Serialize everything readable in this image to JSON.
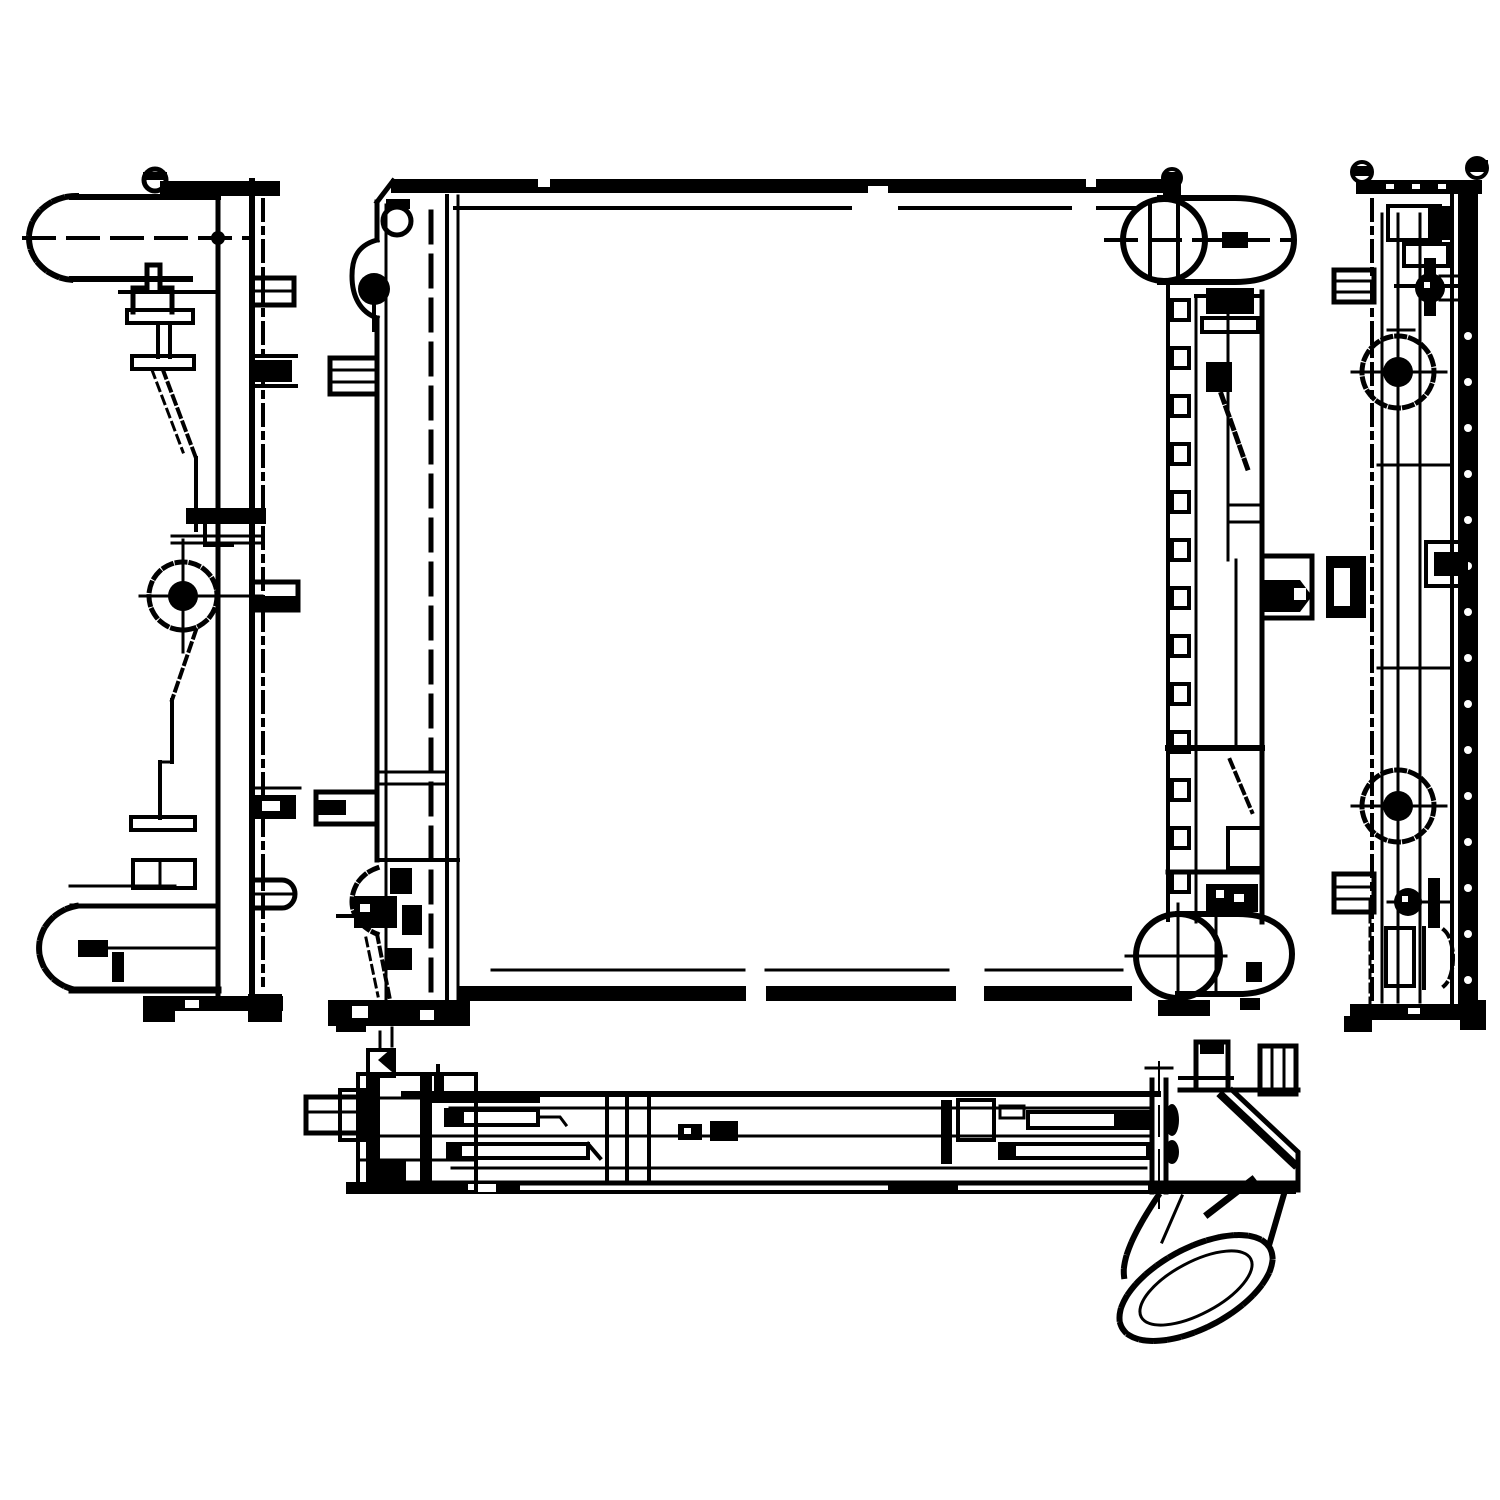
{
  "colors": {
    "ink": "#000000",
    "background": "#ffffff"
  },
  "drawing": {
    "type": "technical-line-drawing",
    "subject": "Automotive radiator shown as a four-view orthographic engineering drawing, black ink on white",
    "views": [
      {
        "id": "left-side-view",
        "label": "Left side profile view with upper hose pipe, lower hose pipe, centre mounting boss and mounting tabs"
      },
      {
        "id": "front-view",
        "label": "Front elevation with blank core, left side tank, right side tank with slotted rail, top-right inlet pipe and bottom-right outlet pipe"
      },
      {
        "id": "right-side-view",
        "label": "Right side profile view with riveted frame rail, two mounting bosses and side tabs"
      },
      {
        "id": "bottom-view",
        "label": "Bottom view with small left nozzle, internal slots, end flange and 45-degree outlet elbow pipe"
      }
    ]
  }
}
